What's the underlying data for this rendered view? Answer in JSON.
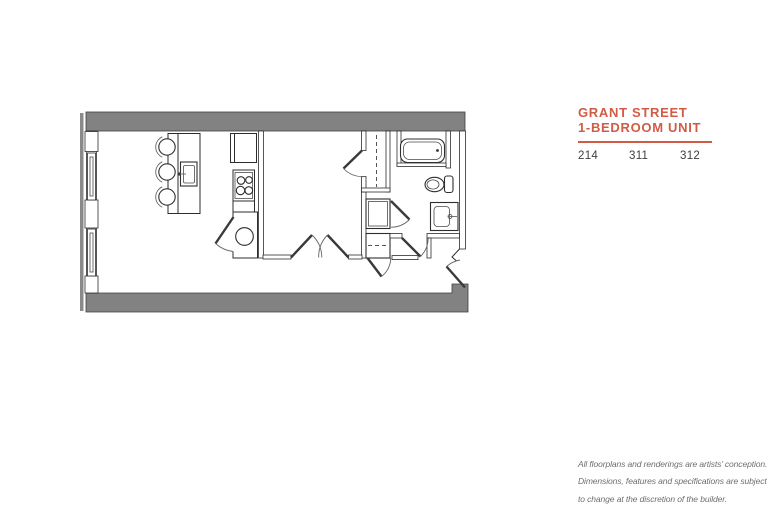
{
  "theme": {
    "accent": "#d15b45",
    "wall": "#828282",
    "line": "#2d2d2d",
    "text-dark": "#3e3e3e",
    "text-muted": "#6e6e6e"
  },
  "unit_info": {
    "title_line1": "GRANT STREET",
    "title_line2": "1-BEDROOM UNIT",
    "unit_numbers": [
      "214",
      "311",
      "312"
    ]
  },
  "disclaimer": {
    "line1": "All floorplans and renderings are artists’ conception.",
    "line2": "Dimensions, features and specifications are subject",
    "line3": "to change at the discretion of the builder."
  },
  "floorplan": {
    "description": "1-bedroom unit architectural floor plan",
    "elements": [
      "exterior-walls",
      "windows",
      "kitchen-island",
      "bar-stools",
      "island-sink",
      "refrigerator",
      "stove",
      "utility-closet",
      "water-heater",
      "bedroom",
      "double-doors",
      "bedroom-door",
      "closet-rod",
      "washer-dryer",
      "linen-closet",
      "bathroom",
      "bathtub",
      "toilet",
      "sink-vanity",
      "entry-door"
    ]
  }
}
